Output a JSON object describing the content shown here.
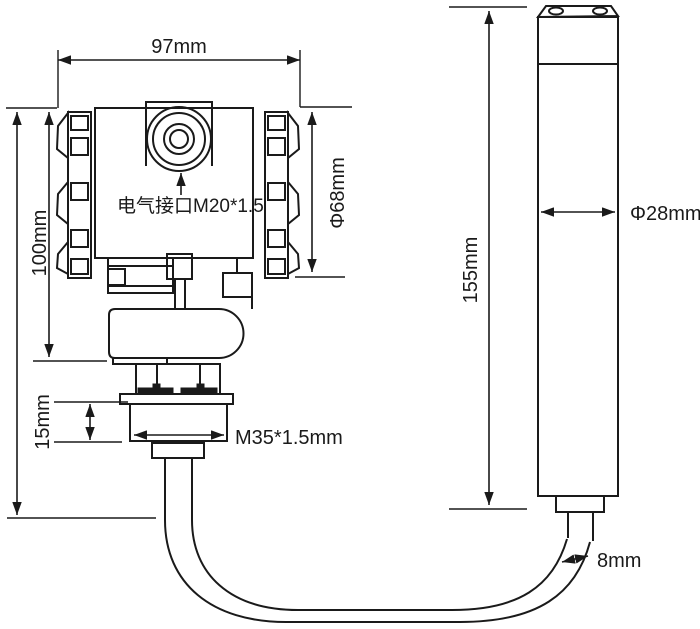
{
  "diagram": {
    "type": "technical-dimension-drawing",
    "subject": "submersible level transmitter with sensor probe and cable",
    "colors": {
      "background": "#ffffff",
      "line": "#1a1a1a"
    },
    "labels": {
      "top_width": "97mm",
      "housing_height": "100mm",
      "electrical_interface": "电气接口M20*1.5",
      "housing_diameter": "Φ68mm",
      "thread_height": "15mm",
      "thread_spec": "M35*1.5mm",
      "probe_length": "155mm",
      "probe_diameter": "Φ28mm",
      "cable_diameter": "8mm"
    }
  }
}
